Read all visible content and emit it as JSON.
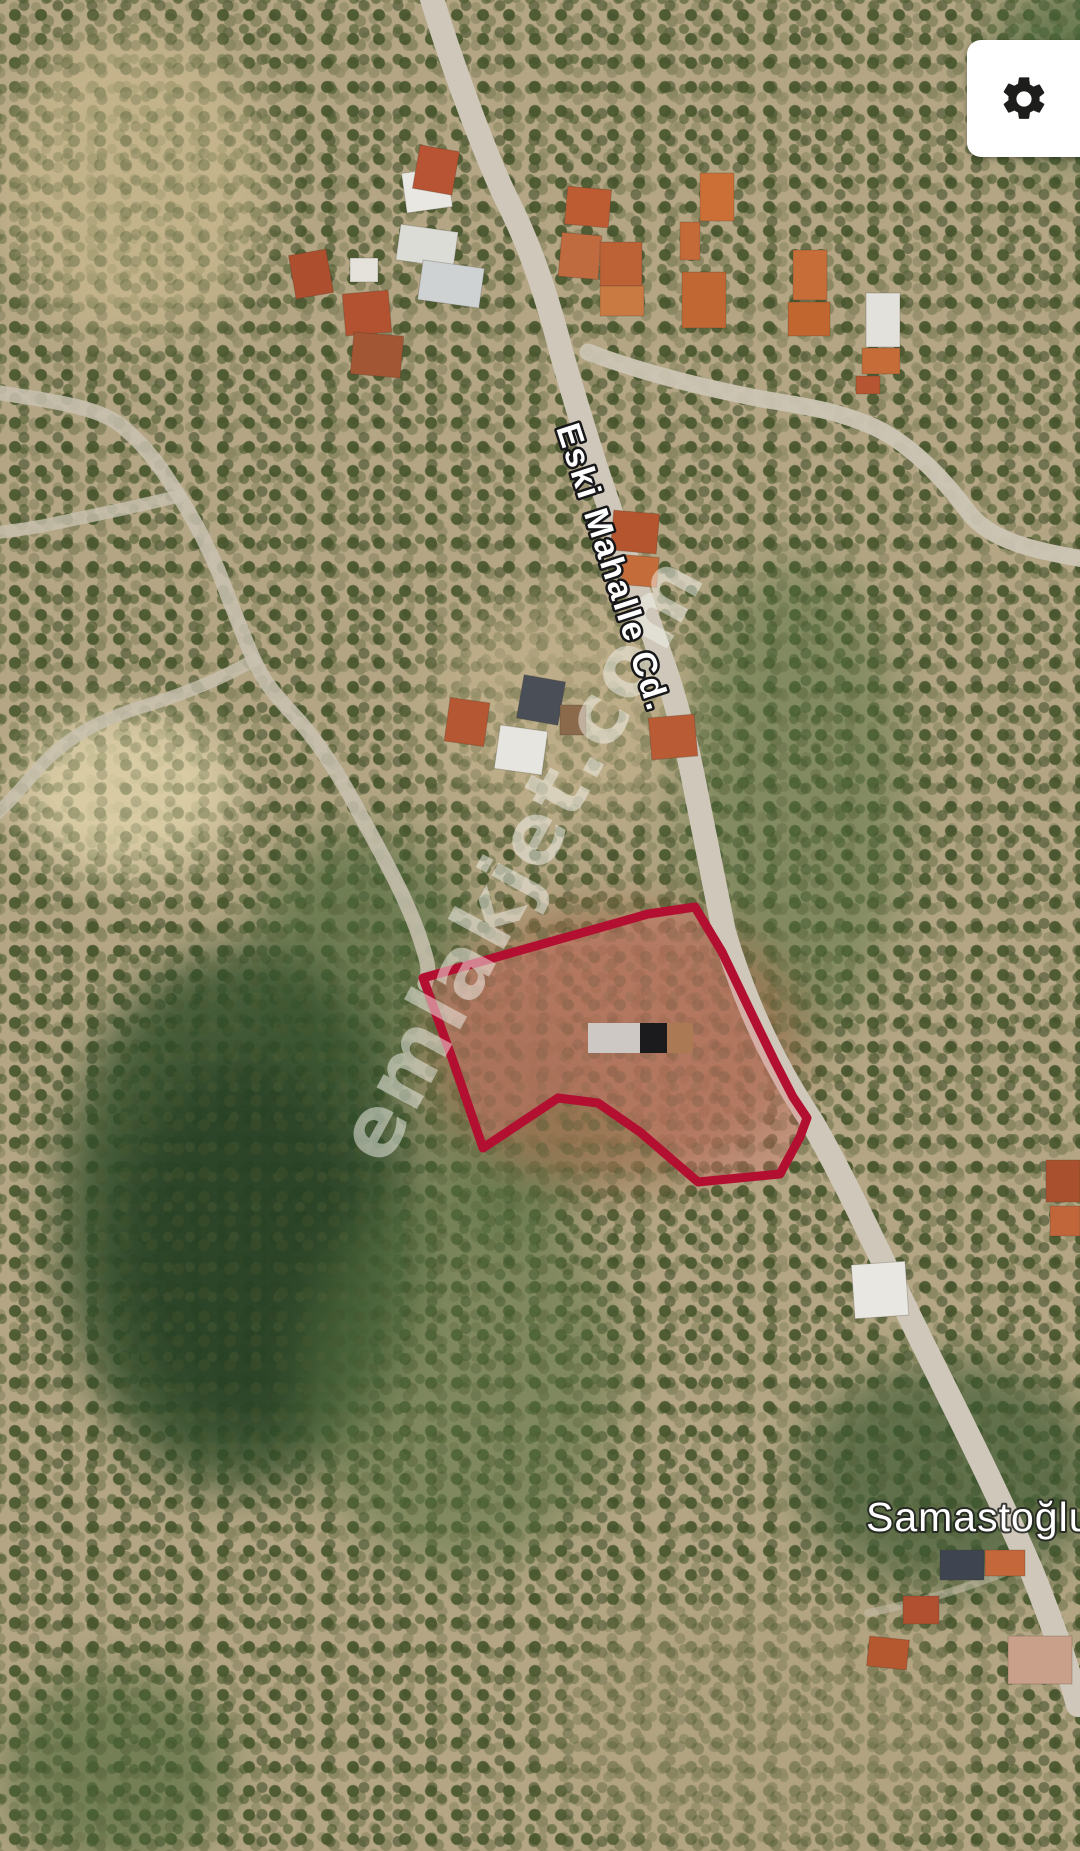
{
  "map": {
    "type": "satellite",
    "road_label": "Eski Mahalle Cd.",
    "place_label": "Samastoğlu",
    "watermark": "emlakjet.com"
  },
  "parcel": {
    "border_color": "#b30f31",
    "fill_color": "rgba(226,112,112,0.30)",
    "points": "423,978 648,914 695,907 722,952 757,1025 775,1062 793,1097 807,1118 800,1137 780,1174 698,1182 640,1132 598,1103 558,1098 483,1148 452,1058"
  },
  "redacted_label": {
    "segment1_color": "#cdc8c4",
    "segment2_color": "#1b1b1d",
    "segment3_color": "#ab7a55"
  },
  "controls": {
    "settings_icon": "gear",
    "icon_color": "#1d1d1b"
  }
}
